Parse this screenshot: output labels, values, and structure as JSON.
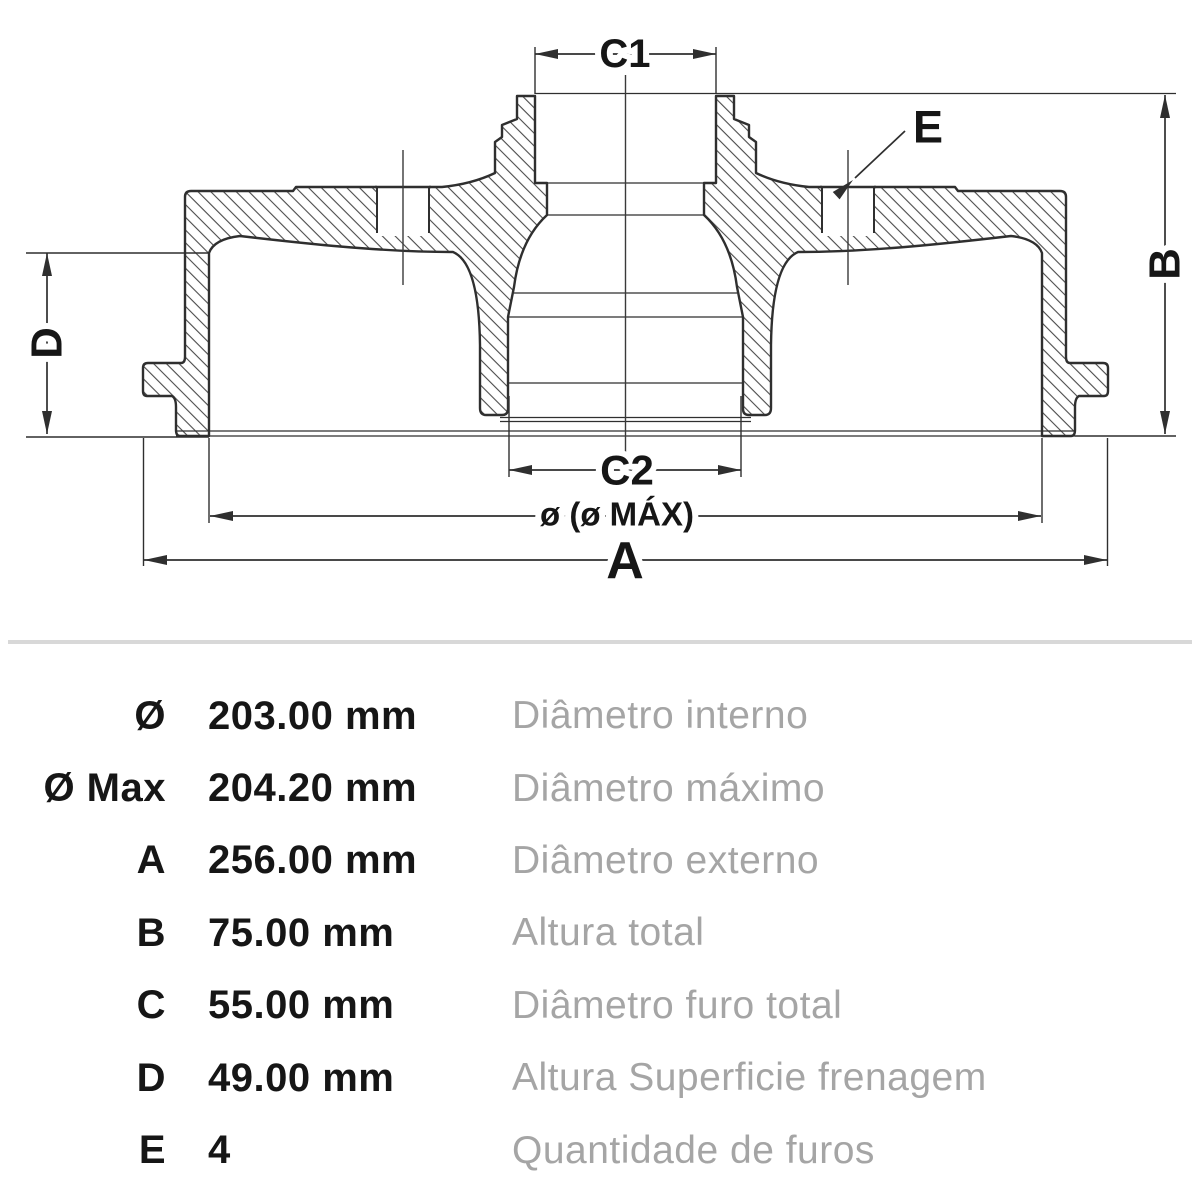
{
  "drawing": {
    "labels": {
      "c1": "C1",
      "c2": "C2",
      "a": "A",
      "b": "B",
      "d": "D",
      "e": "E",
      "dia": "ø (ø MÁX)"
    }
  },
  "table": {
    "rows": [
      {
        "symbol": "Ø",
        "value": "203.00 mm",
        "desc": "Diâmetro interno"
      },
      {
        "symbol": "Ø Max",
        "value": "204.20 mm",
        "desc": "Diâmetro máximo"
      },
      {
        "symbol": "A",
        "value": "256.00 mm",
        "desc": "Diâmetro externo"
      },
      {
        "symbol": "B",
        "value": "75.00 mm",
        "desc": "Altura total"
      },
      {
        "symbol": "C",
        "value": "55.00 mm",
        "desc": "Diâmetro furo total"
      },
      {
        "symbol": "D",
        "value": "49.00 mm",
        "desc": "Altura Superficie frenagem"
      },
      {
        "symbol": "E",
        "value": "4",
        "desc": "Quantidade de furos"
      }
    ]
  },
  "colors": {
    "line": "#2f2f2f",
    "hatch": "#4a4a4a",
    "text": "#161616",
    "muted_text": "#a5a5a5",
    "divider": "#d8d8d8",
    "background": "#ffffff"
  }
}
